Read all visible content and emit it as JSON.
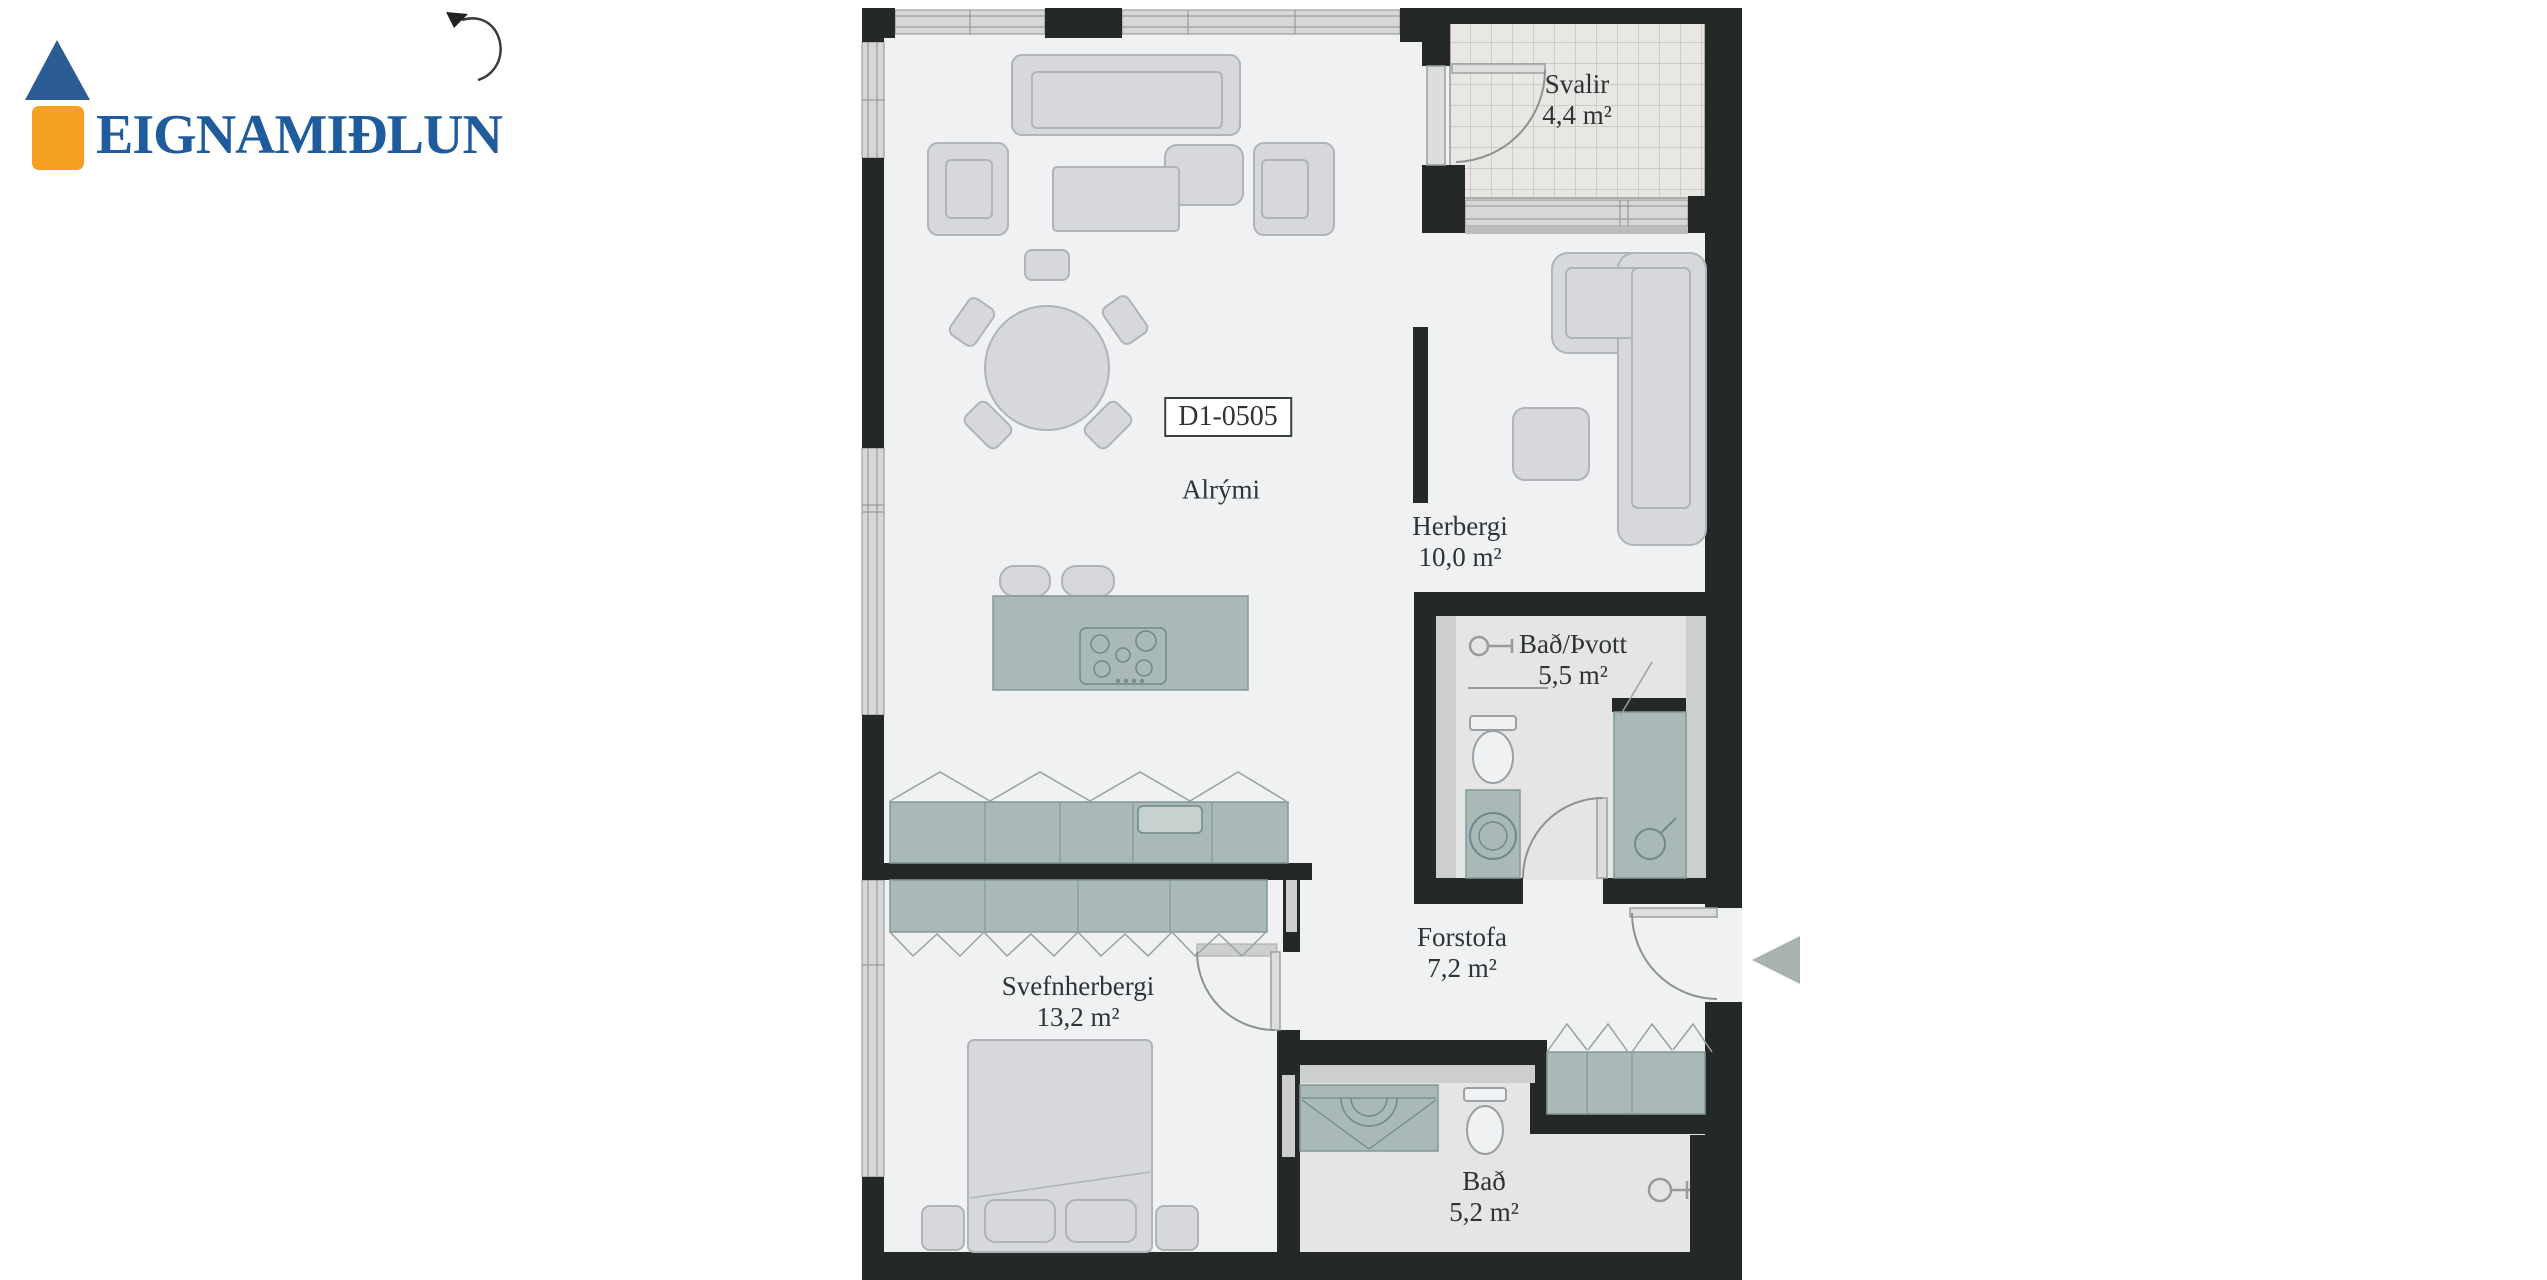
{
  "logo": {
    "brand": "EIGNAMIÐLUN",
    "colors": {
      "blue": "#275d99",
      "orange": "#f5a01f"
    }
  },
  "plan": {
    "unit_label": "D1-0505",
    "rooms": [
      {
        "id": "svalir",
        "name": "Svalir",
        "area": "4,4 m²"
      },
      {
        "id": "alrymi",
        "name": "Alrými",
        "area": ""
      },
      {
        "id": "herbergi",
        "name": "Herbergi",
        "area": "10,0 m²"
      },
      {
        "id": "bad-thvott",
        "name": "Bað/Þvott",
        "area": "5,5 m²"
      },
      {
        "id": "forstofa",
        "name": "Forstofa",
        "area": "7,2 m²"
      },
      {
        "id": "svefnherbergi",
        "name": "Svefnherbergi",
        "area": "13,2 m²"
      },
      {
        "id": "bad",
        "name": "Bað",
        "area": "5,2 m²"
      }
    ],
    "colors": {
      "wall": "#242927",
      "floor": "#eff1f2",
      "wet_floor": "#e4e5e4",
      "balcony_floor": "#e9e7e3",
      "cabinet": "#aebcba",
      "furniture": "#d6d8db",
      "window": "#d6d7d6",
      "label": "#2e3336",
      "entrance_arrow": "#a7b2b1"
    }
  },
  "icons": {
    "north": "north-arrow-icon",
    "entrance": "entrance-arrow-icon"
  }
}
